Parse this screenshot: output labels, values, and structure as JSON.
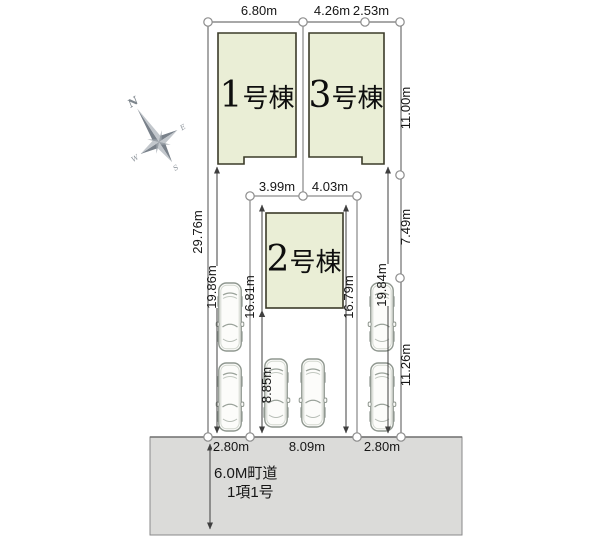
{
  "colors": {
    "plot": "#c9cc8e",
    "building": "#eaeed6",
    "building_border": "#3b3b29",
    "road": "#dbdbd9",
    "dimension_line": "#3f3f3f",
    "compass": "#848b92"
  },
  "site_plan": {
    "buildings": [
      {
        "num": "1",
        "suffix": "号棟"
      },
      {
        "num": "3",
        "suffix": "号棟"
      },
      {
        "num": "2",
        "suffix": "号棟"
      }
    ],
    "dims": {
      "top": [
        "6.80m",
        "4.26m",
        "2.53m"
      ],
      "upper_inner": [
        "3.99m",
        "4.03m"
      ],
      "left": "29.76m",
      "right": [
        "11.00m",
        "7.49m",
        "11.26m"
      ],
      "vertical": {
        "left_parking": "19.86m",
        "b2_left": "16.81m",
        "mid_parking": "8.85m",
        "b2_right": "16.79m",
        "right_parking": "19.84m"
      },
      "bottom": [
        "2.80m",
        "8.09m",
        "2.80m"
      ]
    },
    "road": {
      "line1": "6.0M町道",
      "line2": "1項1号"
    },
    "compass": {
      "n": "N",
      "e": "E",
      "s": "S",
      "w": "W"
    }
  }
}
